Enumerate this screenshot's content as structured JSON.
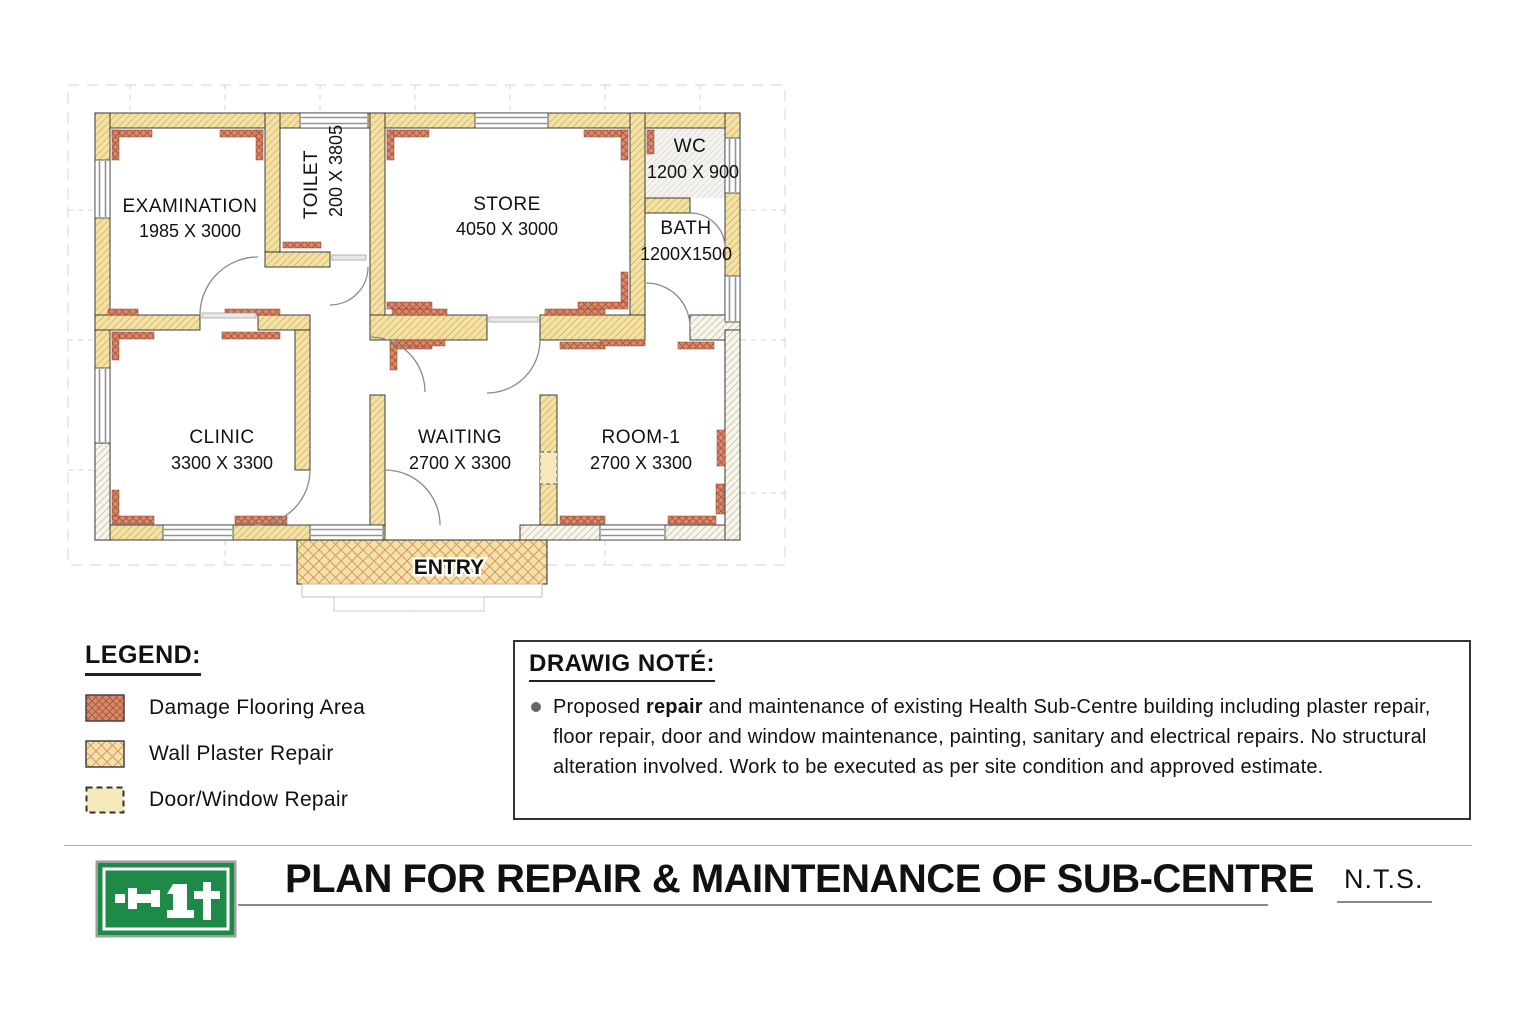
{
  "plan": {
    "rooms": [
      {
        "name": "EXAMINATION",
        "dims": "1985 X 3000"
      },
      {
        "name": "TOILET",
        "dims": "200 X 3805"
      },
      {
        "name": "STORE",
        "dims": "4050 X 3000"
      },
      {
        "name": "WC",
        "dims": "1200 X 900"
      },
      {
        "name": "BATH",
        "dims": "1200X1500"
      },
      {
        "name": "CLINIC",
        "dims": "3300 X 3300"
      },
      {
        "name": "WAITING",
        "dims": "2700 X 3300"
      },
      {
        "name": "ROOM-1",
        "dims": "2700 X 3300"
      }
    ],
    "entry_label": "ENTRY"
  },
  "legend": {
    "title": "LEGEND:",
    "items": [
      {
        "label": "Damage Flooring Area",
        "swatch": "damage-flooring"
      },
      {
        "label": "Wall Plaster Repair",
        "swatch": "wall-plaster"
      },
      {
        "label": "Door/Window Repair",
        "swatch": "door-window"
      }
    ]
  },
  "drawing_note": {
    "title": "DRAWIG NOTÉ:",
    "bullet_prefix": "Proposed ",
    "bullet_bold": "repair",
    "bullet_rest": "  and maintenance of existing Health Sub-Centre building including plaster repair, floor repair, door and window maintenance, painting, sanitary and electrical repairs. No structural alteration involved. Work to be executed as per site condition and approved estimate."
  },
  "title_block": {
    "title": "PLAN FOR REPAIR & MAINTENANCE OF SUB-CENTRE",
    "scale": "N.T.S."
  },
  "colors": {
    "wall_fill": "#F2E2A4",
    "wall_hatch": "#D9B06C",
    "damage_fill": "#D98A6A",
    "damage_hatch": "#A8543A",
    "plaster_x_hatch": "#D98A6A",
    "gray_wall_hatch": "#C9BFA6",
    "logo_green": "#1E8A47",
    "outline": "#2B2B2B"
  }
}
